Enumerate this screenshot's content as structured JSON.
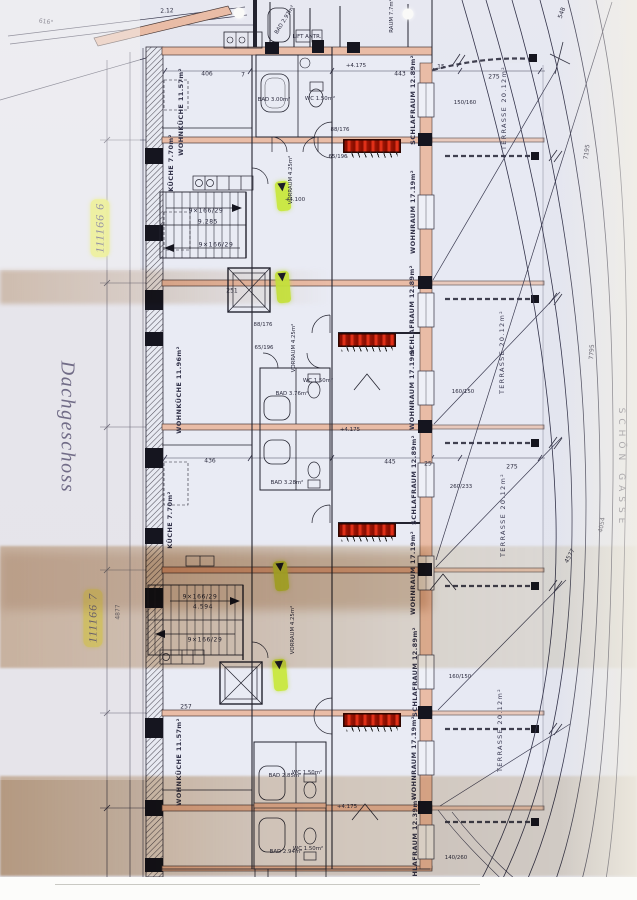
{
  "document": {
    "type": "scanned architectural floor plan",
    "floor_name": "Dachgeschoss",
    "street_label": "SCHÖN GASSE",
    "plan_marks": [
      "111166 6",
      "111166 7"
    ]
  },
  "colors": {
    "paper": "#e3e5ee",
    "ink": "#2b2b3e",
    "wall_fill": "#e9bca6",
    "radiator_red": "#c01500",
    "highlight_yellow": "#e9f046",
    "arrow_green": "#c8e83c",
    "tan_stain": "#c3a583"
  },
  "plan_labels": [
    {
      "name": "floor-title",
      "text": "Dachgeschoss",
      "x": 67,
      "y": 427,
      "rot": 90,
      "cls": "hand"
    },
    {
      "name": "plan-mark-1",
      "text": "111166 6",
      "x": 100,
      "y": 228,
      "rot": -90,
      "cls": "ymark"
    },
    {
      "name": "plan-mark-2",
      "text": "111166 7",
      "x": 93,
      "y": 618,
      "rot": -90,
      "cls": "ymark"
    },
    {
      "name": "street-name",
      "text": "SCHÖN GASSE",
      "x": 621,
      "y": 468,
      "rot": 90,
      "cls": "street"
    },
    {
      "name": "room-schlafraum-1",
      "text": "SCHLAFRAUM 12.89m²",
      "x": 413,
      "y": 100,
      "rot": -90,
      "cls": "room"
    },
    {
      "name": "room-wohnraum-1",
      "text": "WOHNRAUM 17.19m²",
      "x": 413,
      "y": 212,
      "rot": -90,
      "cls": "room"
    },
    {
      "name": "room-schlafraum-2",
      "text": "SCHLAFRAUM 12.89m²",
      "x": 412,
      "y": 310,
      "rot": -90,
      "cls": "room"
    },
    {
      "name": "room-wohnraum-2",
      "text": "WOHNRAUM 17.19m²",
      "x": 412,
      "y": 388,
      "rot": -90,
      "cls": "room"
    },
    {
      "name": "room-schlafraum-3",
      "text": "SCHLAFRAUM 12.89m²",
      "x": 414,
      "y": 480,
      "rot": -90,
      "cls": "room"
    },
    {
      "name": "room-wohnraum-3",
      "text": "WOHNRAUM 17.19m²",
      "x": 413,
      "y": 573,
      "rot": -90,
      "cls": "room"
    },
    {
      "name": "room-schlafraum-4",
      "text": "SCHLAFRAUM 12.89m²",
      "x": 415,
      "y": 672,
      "rot": -90,
      "cls": "room"
    },
    {
      "name": "room-wohnraum-4",
      "text": "WOHNRAUM 17.19m²",
      "x": 414,
      "y": 758,
      "rot": -90,
      "cls": "room"
    },
    {
      "name": "room-schlafraum-5",
      "text": "SCHLAFRAUM 12.39m²",
      "x": 415,
      "y": 842,
      "rot": -90,
      "cls": "room"
    },
    {
      "name": "room-wohnkueche-1",
      "text": "WOHNKÜCHE 11.57m²",
      "x": 181,
      "y": 112,
      "rot": -90,
      "cls": "room"
    },
    {
      "name": "room-kueche-1",
      "text": "KÜCHE 7.70m²",
      "x": 171,
      "y": 163,
      "rot": -90,
      "cls": "room"
    },
    {
      "name": "room-wohnkueche-2",
      "text": "WOHNKÜCHE 11.96m²",
      "x": 179,
      "y": 390,
      "rot": -90,
      "cls": "room"
    },
    {
      "name": "room-kueche-2",
      "text": "KÜCHE 7.70m²",
      "x": 170,
      "y": 520,
      "rot": -90,
      "cls": "room"
    },
    {
      "name": "room-wohnkueche-3",
      "text": "WOHNKÜCHE 11.57m²",
      "x": 179,
      "y": 762,
      "rot": -90,
      "cls": "room"
    },
    {
      "name": "room-terrasse-1",
      "text": "TERRASSE 20.12m²",
      "x": 504,
      "y": 108,
      "rot": -90,
      "cls": "terr"
    },
    {
      "name": "room-terrasse-2",
      "text": "TERRASSE 20.12m²",
      "x": 502,
      "y": 352,
      "rot": -90,
      "cls": "terr"
    },
    {
      "name": "room-terrasse-3",
      "text": "TERRASSE 20.12m²",
      "x": 503,
      "y": 515,
      "rot": -90,
      "cls": "terr"
    },
    {
      "name": "room-terrasse-4",
      "text": "TERRASSE 20.12m²",
      "x": 500,
      "y": 730,
      "rot": -90,
      "cls": "terr"
    },
    {
      "name": "room-vorraum-1",
      "text": "VORRAUM 4.25m²",
      "x": 291,
      "y": 180,
      "rot": -90,
      "cls": "tag"
    },
    {
      "name": "room-vorraum-2",
      "text": "VORRAUM 4.25m²",
      "x": 294,
      "y": 348,
      "rot": -90,
      "cls": "tag"
    },
    {
      "name": "room-vorraum-3",
      "text": "VORRAUM 4.25m²",
      "x": 293,
      "y": 630,
      "rot": -90,
      "cls": "tag"
    },
    {
      "name": "room-bad-1",
      "text": "BAD 3.00m²",
      "x": 274,
      "y": 100,
      "rot": 0,
      "cls": "tag"
    },
    {
      "name": "room-wc-1",
      "text": "WC 1.50m²",
      "x": 320,
      "y": 99,
      "rot": 0,
      "cls": "tag"
    },
    {
      "name": "room-bad-2",
      "text": "BAD 3.76m²",
      "x": 292,
      "y": 394,
      "rot": 0,
      "cls": "tag"
    },
    {
      "name": "room-wc-2",
      "text": "WC 1.50m²",
      "x": 318,
      "y": 381,
      "rot": 0,
      "cls": "tag"
    },
    {
      "name": "room-bad-3",
      "text": "BAD 3.28m²",
      "x": 287,
      "y": 483,
      "rot": 0,
      "cls": "tag"
    },
    {
      "name": "room-bad-4",
      "text": "BAD 2.85m²",
      "x": 285,
      "y": 776,
      "rot": 0,
      "cls": "tag"
    },
    {
      "name": "room-wc-4",
      "text": "WC 1.50m²",
      "x": 307,
      "y": 773,
      "rot": 0,
      "cls": "tag"
    },
    {
      "name": "room-bad-5",
      "text": "BAD 2.94m²",
      "x": 286,
      "y": 852,
      "rot": 0,
      "cls": "tag"
    },
    {
      "name": "room-wc-5",
      "text": "WC 1.50m²",
      "x": 308,
      "y": 849,
      "rot": 0,
      "cls": "tag"
    },
    {
      "name": "room-bad-top",
      "text": "BAD 2.97m²",
      "x": 285,
      "y": 20,
      "rot": -58,
      "cls": "tag"
    },
    {
      "name": "room-raum-top",
      "text": "RAUM 7.7m²",
      "x": 392,
      "y": 16,
      "rot": -90,
      "cls": "tag"
    },
    {
      "name": "lift-antrieb",
      "text": "LIFT ANTR.",
      "x": 307,
      "y": 37,
      "rot": 0,
      "cls": "tag"
    },
    {
      "name": "stair-text-1",
      "text": "9×166/29",
      "x": 206,
      "y": 211,
      "rot": 0,
      "cls": "stair"
    },
    {
      "name": "stair-text-2",
      "text": "9.285",
      "x": 208,
      "y": 222,
      "rot": 0,
      "cls": "stair"
    },
    {
      "name": "stair-text-3",
      "text": "9×166/29",
      "x": 216,
      "y": 245,
      "rot": 0,
      "cls": "stair"
    },
    {
      "name": "stair-text-4",
      "text": "9×166/29",
      "x": 200,
      "y": 597,
      "rot": 0,
      "cls": "stair"
    },
    {
      "name": "stair-text-5",
      "text": "4.594",
      "x": 203,
      "y": 607,
      "rot": 0,
      "cls": "stair"
    },
    {
      "name": "stair-text-6",
      "text": "9×166/29",
      "x": 205,
      "y": 640,
      "rot": 0,
      "cls": "stair"
    },
    {
      "name": "dim-406",
      "text": "406",
      "x": 207,
      "y": 74,
      "rot": 0,
      "cls": "dim"
    },
    {
      "name": "dim-7a",
      "text": "7",
      "x": 243,
      "y": 75,
      "rot": 0,
      "cls": "dim"
    },
    {
      "name": "dim-443",
      "text": "443",
      "x": 400,
      "y": 74,
      "rot": 0,
      "cls": "dim"
    },
    {
      "name": "dim-15",
      "text": "15",
      "x": 441,
      "y": 67,
      "rot": 0,
      "cls": "dim"
    },
    {
      "name": "dim-275a",
      "text": "275",
      "x": 494,
      "y": 77,
      "rot": 0,
      "cls": "dim"
    },
    {
      "name": "dim-436",
      "text": "436",
      "x": 210,
      "y": 461,
      "rot": 0,
      "cls": "dim"
    },
    {
      "name": "dim-445",
      "text": "445",
      "x": 390,
      "y": 462,
      "rot": 0,
      "cls": "dim"
    },
    {
      "name": "dim-25",
      "text": "25",
      "x": 428,
      "y": 464,
      "rot": 0,
      "cls": "dim"
    },
    {
      "name": "dim-275b",
      "text": "275",
      "x": 512,
      "y": 467,
      "rot": 0,
      "cls": "dim"
    },
    {
      "name": "dim-251",
      "text": "251",
      "x": 232,
      "y": 291,
      "rot": 0,
      "cls": "dim"
    },
    {
      "name": "dim-257",
      "text": "257",
      "x": 186,
      "y": 707,
      "rot": 0,
      "cls": "dim"
    },
    {
      "name": "dim-212",
      "text": "2.12",
      "x": 167,
      "y": 11,
      "rot": -3,
      "cls": "dim"
    },
    {
      "name": "dim-angle",
      "text": "616°",
      "x": 46,
      "y": 22,
      "rot": 8,
      "cls": "dim"
    },
    {
      "name": "win-150-160",
      "text": "150/160",
      "x": 465,
      "y": 103,
      "rot": 0,
      "cls": "tag"
    },
    {
      "name": "win-160-150a",
      "text": "160/150",
      "x": 463,
      "y": 392,
      "rot": 0,
      "cls": "tag"
    },
    {
      "name": "win-260-233",
      "text": "260/233",
      "x": 461,
      "y": 487,
      "rot": 0,
      "cls": "tag"
    },
    {
      "name": "win-160-150b",
      "text": "160/150",
      "x": 460,
      "y": 677,
      "rot": 0,
      "cls": "tag"
    },
    {
      "name": "win-140-260",
      "text": "140/260",
      "x": 456,
      "y": 858,
      "rot": 0,
      "cls": "tag"
    },
    {
      "name": "level-4175a",
      "text": "+4.175",
      "x": 356,
      "y": 66,
      "rot": 0,
      "cls": "level"
    },
    {
      "name": "level-4100",
      "text": "+4.100",
      "x": 295,
      "y": 200,
      "rot": 0,
      "cls": "level"
    },
    {
      "name": "level-4175b",
      "text": "+4.175",
      "x": 350,
      "y": 430,
      "rot": 0,
      "cls": "level"
    },
    {
      "name": "level-4175c",
      "text": "+4.175",
      "x": 347,
      "y": 807,
      "rot": 0,
      "cls": "level"
    },
    {
      "name": "door-88-176a",
      "text": "88/176",
      "x": 340,
      "y": 130,
      "rot": 0,
      "cls": "tag"
    },
    {
      "name": "door-65-196a",
      "text": "65/196",
      "x": 338,
      "y": 157,
      "rot": 0,
      "cls": "tag"
    },
    {
      "name": "door-88-176b",
      "text": "88/176",
      "x": 263,
      "y": 325,
      "rot": 0,
      "cls": "tag"
    },
    {
      "name": "door-65-196b",
      "text": "65/196",
      "x": 264,
      "y": 348,
      "rot": 0,
      "cls": "tag"
    },
    {
      "name": "dim-548",
      "text": "548",
      "x": 562,
      "y": 13,
      "rot": -70,
      "cls": "dim"
    },
    {
      "name": "dim-7195",
      "text": "7195",
      "x": 587,
      "y": 152,
      "rot": -82,
      "cls": "dim"
    },
    {
      "name": "dim-7795",
      "text": "7795",
      "x": 592,
      "y": 352,
      "rot": -86,
      "cls": "dim"
    },
    {
      "name": "dim-4054",
      "text": "4054",
      "x": 602,
      "y": 525,
      "rot": -80,
      "cls": "dim"
    },
    {
      "name": "dim-4577",
      "text": "4577",
      "x": 570,
      "y": 556,
      "rot": -62,
      "cls": "dim"
    },
    {
      "name": "dim-4877",
      "text": "4877",
      "x": 118,
      "y": 612,
      "rot": -90,
      "cls": "dim"
    }
  ],
  "radiators": [
    {
      "name": "radiator-1",
      "x": 372,
      "y": 146,
      "w": 55,
      "h": 11
    },
    {
      "name": "radiator-2",
      "x": 367,
      "y": 340,
      "w": 55,
      "h": 11
    },
    {
      "name": "radiator-3",
      "x": 367,
      "y": 530,
      "w": 55,
      "h": 11
    },
    {
      "name": "radiator-4",
      "x": 372,
      "y": 720,
      "w": 55,
      "h": 11
    }
  ],
  "highlight_arrows": [
    {
      "name": "entry-arrow-1",
      "x": 283,
      "y": 196,
      "w": 14,
      "h": 30,
      "rot": -6,
      "glyph": "▼"
    },
    {
      "name": "entry-arrow-2",
      "x": 283,
      "y": 287,
      "w": 14,
      "h": 32,
      "rot": -5,
      "glyph": "▼"
    },
    {
      "name": "entry-arrow-3",
      "x": 281,
      "y": 576,
      "w": 14,
      "h": 30,
      "rot": -6,
      "glyph": "▼"
    },
    {
      "name": "entry-arrow-4",
      "x": 280,
      "y": 675,
      "w": 14,
      "h": 32,
      "rot": -5,
      "glyph": "▼"
    }
  ],
  "scan_artifacts": [
    {
      "name": "punch-hole-1",
      "x": 239,
      "y": 13
    },
    {
      "name": "punch-hole-2",
      "x": 408,
      "y": 14
    }
  ]
}
